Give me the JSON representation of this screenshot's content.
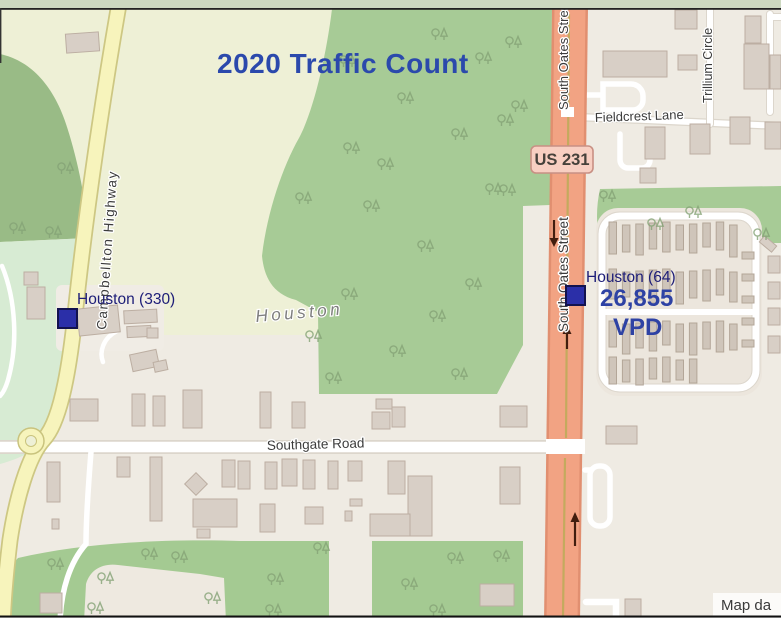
{
  "title": "2020 Traffic Count",
  "colors": {
    "title_blue": "#2b49ac",
    "count_blue": "#2e42a4",
    "marker_fill": "#2b2fa8",
    "marker_stroke": "#12124f",
    "label_navy": "#1d1d78",
    "road_orange": "#f2a383",
    "shield_fill": "#f8cfc2"
  },
  "streets": {
    "south_oates": "South Oates Street",
    "campbellton": "Campbellton Highway",
    "southgate": "Southgate Road",
    "fieldcrest": "Fieldcrest Lane",
    "trillium": "Trillium Circle"
  },
  "place_label": "Houston",
  "highway_shield": "US 231",
  "markers": {
    "west": {
      "label": "Houston (330)"
    },
    "east": {
      "label": "Houston (64)",
      "volume": "26,855",
      "unit": "VPD"
    }
  },
  "attribution": "Map da"
}
